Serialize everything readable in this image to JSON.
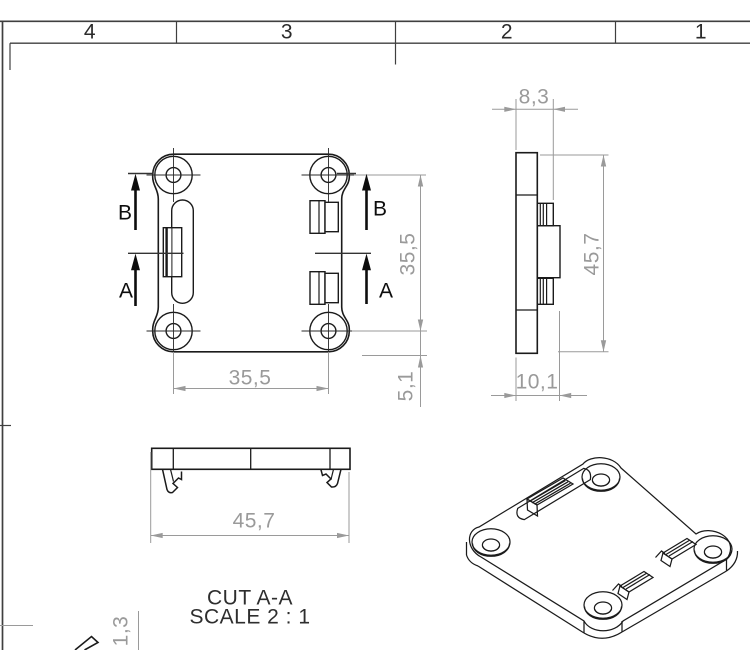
{
  "sheet": {
    "zone_labels": [
      "4",
      "3",
      "2",
      "1"
    ]
  },
  "front_view": {
    "section_labels": {
      "b_left": "B",
      "a_left": "A",
      "b_right": "B",
      "a_right": "A"
    },
    "dimensions": {
      "width": "35,5",
      "height": "35,5",
      "hole_edge_offset": "5,1"
    }
  },
  "side_view": {
    "dimensions": {
      "clip_width": "8,3",
      "height": "45,7",
      "total_thickness": "10,1"
    }
  },
  "section_view": {
    "label": "CUT A-A",
    "scale": "SCALE 2 : 1",
    "dimensions": {
      "width": "45,7"
    }
  },
  "detail_partial": {
    "dimensions": {
      "thickness": "1,3"
    }
  },
  "colors": {
    "part_line": "#1b1b1b",
    "dimension": "#9a9a9a",
    "border": "#3f3f3f",
    "section_arrow": "#0d0d0d",
    "background": "#ffffff"
  }
}
